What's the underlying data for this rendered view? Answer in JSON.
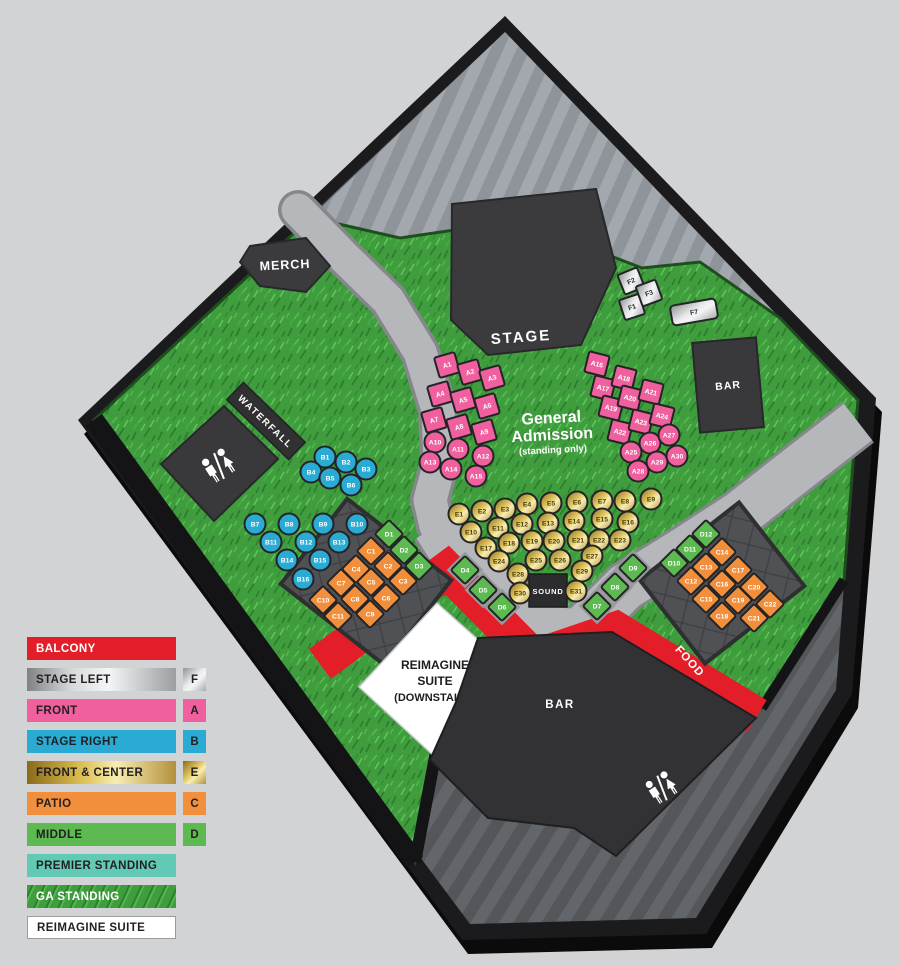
{
  "map": {
    "labels": {
      "stage": "STAGE",
      "merch": "MERCH",
      "waterfall": "WATERFALL",
      "bar_stage": "BAR",
      "bar_main": "BAR",
      "food": "FOOD",
      "balcony": "BALCONY",
      "sound": "SOUND",
      "ga_line1": "General",
      "ga_line2": "Admission",
      "ga_line3": "(standing only)",
      "suite_line1": "REIMAGINE",
      "suite_line2": "SUITE",
      "suite_line3": "(DOWNSTAIRS)"
    },
    "colors": {
      "balcony_red": "#e31e29",
      "front_pink": "#f0609e",
      "stage_right_cyan": "#29abd4",
      "patio_orange": "#f28f3d",
      "middle_green": "#5cba51",
      "premier_teal": "#62c9b5",
      "grass_green": "#3f9d3e",
      "gold_dark": "#8a6a1c",
      "gold_light": "#f8edb2",
      "silver_dark": "#8f9194",
      "silver_light": "#f4f5f6"
    },
    "seat_sections": [
      {
        "name": "front",
        "code": "A",
        "fill": "#f0609e",
        "text": "#ffffff",
        "seats": [
          [
            "A1",
            447,
            365,
            "sq",
            -16
          ],
          [
            "A2",
            470,
            372,
            "sq",
            -16
          ],
          [
            "A3",
            492,
            378,
            "sq",
            -16
          ],
          [
            "A4",
            440,
            394,
            "sq",
            -16
          ],
          [
            "A5",
            463,
            400,
            "sq",
            -16
          ],
          [
            "A6",
            487,
            406,
            "sq",
            -16
          ],
          [
            "A7",
            434,
            420,
            "sq",
            -16
          ],
          [
            "A8",
            459,
            427,
            "sq",
            -16
          ],
          [
            "A9",
            484,
            432,
            "sq",
            -16
          ],
          [
            "A10",
            435,
            442,
            "ci",
            0
          ],
          [
            "A11",
            458,
            449,
            "ci",
            0
          ],
          [
            "A12",
            483,
            456,
            "ci",
            0
          ],
          [
            "A13",
            430,
            462,
            "ci",
            0
          ],
          [
            "A14",
            451,
            469,
            "ci",
            0
          ],
          [
            "A15",
            476,
            476,
            "ci",
            0
          ],
          [
            "A16",
            597,
            364,
            "sq",
            14
          ],
          [
            "A17",
            603,
            388,
            "sq",
            14
          ],
          [
            "A18",
            624,
            378,
            "sq",
            14
          ],
          [
            "A19",
            611,
            408,
            "sq",
            14
          ],
          [
            "A20",
            630,
            398,
            "sq",
            14
          ],
          [
            "A21",
            651,
            392,
            "sq",
            14
          ],
          [
            "A22",
            620,
            432,
            "sq",
            14
          ],
          [
            "A23",
            641,
            422,
            "sq",
            14
          ],
          [
            "A24",
            662,
            416,
            "sq",
            14
          ],
          [
            "A25",
            631,
            452,
            "ci",
            0
          ],
          [
            "A26",
            650,
            443,
            "ci",
            0
          ],
          [
            "A27",
            669,
            435,
            "ci",
            0
          ],
          [
            "A28",
            638,
            471,
            "ci",
            0
          ],
          [
            "A29",
            657,
            462,
            "ci",
            0
          ],
          [
            "A30",
            677,
            456,
            "ci",
            0
          ]
        ]
      },
      {
        "name": "stage-right",
        "code": "B",
        "fill": "#29abd4",
        "text": "#ffffff",
        "seats": [
          [
            "B1",
            325,
            457,
            "ci",
            0
          ],
          [
            "B2",
            346,
            462,
            "ci",
            0
          ],
          [
            "B3",
            366,
            469,
            "ci",
            0
          ],
          [
            "B4",
            311,
            472,
            "ci",
            0
          ],
          [
            "B5",
            330,
            478,
            "ci",
            0
          ],
          [
            "B6",
            351,
            485,
            "ci",
            0
          ],
          [
            "B7",
            255,
            524,
            "ci",
            0
          ],
          [
            "B8",
            289,
            524,
            "ci",
            0
          ],
          [
            "B9",
            323,
            524,
            "ci",
            0
          ],
          [
            "B10",
            357,
            524,
            "ci",
            0
          ],
          [
            "B11",
            271,
            542,
            "ci",
            0
          ],
          [
            "B12",
            306,
            542,
            "ci",
            0
          ],
          [
            "B13",
            339,
            542,
            "ci",
            0
          ],
          [
            "B14",
            287,
            560,
            "ci",
            0
          ],
          [
            "B15",
            320,
            560,
            "ci",
            0
          ],
          [
            "B16",
            303,
            579,
            "ci",
            0
          ]
        ]
      },
      {
        "name": "patio",
        "code": "C",
        "fill": "#f28f3d",
        "text": "#ffffff",
        "seats": [
          [
            "C1",
            371,
            551,
            "di",
            45
          ],
          [
            "C2",
            388,
            566,
            "di",
            45
          ],
          [
            "C3",
            403,
            581,
            "di",
            45
          ],
          [
            "C4",
            356,
            569,
            "di",
            45
          ],
          [
            "C5",
            371,
            582,
            "di",
            45
          ],
          [
            "C6",
            386,
            598,
            "di",
            45
          ],
          [
            "C7",
            341,
            583,
            "di",
            45
          ],
          [
            "C8",
            355,
            599,
            "di",
            45
          ],
          [
            "C9",
            370,
            614,
            "di",
            45
          ],
          [
            "C10",
            323,
            600,
            "di",
            45
          ],
          [
            "C11",
            338,
            616,
            "di",
            45
          ],
          [
            "C12",
            691,
            581,
            "di",
            45
          ],
          [
            "C13",
            706,
            567,
            "di",
            45
          ],
          [
            "C14",
            722,
            552,
            "di",
            45
          ],
          [
            "C15",
            706,
            599,
            "di",
            45
          ],
          [
            "C16",
            722,
            584,
            "di",
            45
          ],
          [
            "C17",
            738,
            570,
            "di",
            45
          ],
          [
            "C18",
            722,
            616,
            "di",
            45
          ],
          [
            "C19",
            738,
            600,
            "di",
            45
          ],
          [
            "C20",
            754,
            587,
            "di",
            45
          ],
          [
            "C21",
            754,
            618,
            "di",
            45
          ],
          [
            "C22",
            770,
            604,
            "di",
            45
          ]
        ]
      },
      {
        "name": "middle",
        "code": "D",
        "fill": "#5cba51",
        "text": "#ffffff",
        "seats": [
          [
            "D1",
            389,
            534,
            "di",
            45
          ],
          [
            "D2",
            404,
            550,
            "di",
            45
          ],
          [
            "D3",
            419,
            566,
            "di",
            45
          ],
          [
            "D4",
            465,
            570,
            "di",
            45,
            1
          ],
          [
            "D5",
            483,
            590,
            "di",
            45,
            1
          ],
          [
            "D6",
            502,
            607,
            "di",
            45,
            1
          ],
          [
            "D7",
            597,
            606,
            "di",
            45,
            1
          ],
          [
            "D8",
            615,
            587,
            "di",
            45,
            1
          ],
          [
            "D9",
            633,
            568,
            "di",
            45,
            1
          ],
          [
            "D10",
            674,
            563,
            "di",
            45
          ],
          [
            "D11",
            690,
            549,
            "di",
            45
          ],
          [
            "D12",
            706,
            534,
            "di",
            45
          ]
        ]
      },
      {
        "name": "front-center",
        "code": "E",
        "fill": "gold",
        "text": "#4a3a08",
        "seats": [
          [
            "E1",
            459,
            514,
            "ci",
            0
          ],
          [
            "E2",
            482,
            511,
            "ci",
            0
          ],
          [
            "E3",
            505,
            509,
            "ci",
            0
          ],
          [
            "E4",
            527,
            504,
            "ci",
            0
          ],
          [
            "E5",
            551,
            503,
            "ci",
            0
          ],
          [
            "E6",
            577,
            502,
            "ci",
            0
          ],
          [
            "E7",
            602,
            501,
            "ci",
            0
          ],
          [
            "E8",
            625,
            501,
            "ci",
            0
          ],
          [
            "E9",
            651,
            499,
            "ci",
            0
          ],
          [
            "E10",
            471,
            532,
            "ci",
            0
          ],
          [
            "E11",
            498,
            528,
            "ci",
            0
          ],
          [
            "E12",
            522,
            524,
            "ci",
            0
          ],
          [
            "E13",
            548,
            523,
            "ci",
            0
          ],
          [
            "E14",
            574,
            521,
            "ci",
            0
          ],
          [
            "E15",
            602,
            519,
            "ci",
            0
          ],
          [
            "E16",
            628,
            522,
            "ci",
            0
          ],
          [
            "E17",
            486,
            548,
            "ci",
            0
          ],
          [
            "E18",
            509,
            543,
            "ci",
            0
          ],
          [
            "E19",
            532,
            541,
            "ci",
            0
          ],
          [
            "E20",
            554,
            541,
            "ci",
            0
          ],
          [
            "E21",
            578,
            540,
            "ci",
            0
          ],
          [
            "E22",
            599,
            540,
            "ci",
            0
          ],
          [
            "E23",
            620,
            540,
            "ci",
            0
          ],
          [
            "E24",
            499,
            561,
            "ci",
            0
          ],
          [
            "E25",
            536,
            560,
            "ci",
            0
          ],
          [
            "E26",
            560,
            560,
            "ci",
            0
          ],
          [
            "E27",
            592,
            556,
            "ci",
            0
          ],
          [
            "E28",
            518,
            574,
            "ci",
            0
          ],
          [
            "E29",
            582,
            571,
            "ci",
            0
          ],
          [
            "E30",
            520,
            593,
            "ci",
            0
          ],
          [
            "E31",
            576,
            591,
            "ci",
            0
          ]
        ]
      },
      {
        "name": "stage-left",
        "code": "F",
        "fill": "silver",
        "text": "#2b2b2b",
        "seats": [
          [
            "F1",
            632,
            307,
            "sq",
            -18
          ],
          [
            "F2",
            631,
            281,
            "sq",
            -22
          ],
          [
            "F3",
            649,
            293,
            "sq",
            -20
          ],
          [
            "F7",
            694,
            312,
            "pill",
            -10
          ]
        ]
      }
    ]
  },
  "legend": {
    "items": [
      {
        "label": "BALCONY",
        "swatch": "solid",
        "color": "#e31e29",
        "label_color": "#ffffff",
        "chip": null
      },
      {
        "label": "STAGE LEFT",
        "swatch": "silver",
        "color": null,
        "label_color": "#231f20",
        "chip": "F"
      },
      {
        "label": "FRONT",
        "swatch": "solid",
        "color": "#f0609e",
        "label_color": "#231f20",
        "chip": "A"
      },
      {
        "label": "STAGE RIGHT",
        "swatch": "solid",
        "color": "#29abd4",
        "label_color": "#231f20",
        "chip": "B"
      },
      {
        "label": "FRONT & CENTER",
        "swatch": "gold",
        "color": null,
        "label_color": "#231f20",
        "chip": "E"
      },
      {
        "label": "PATIO",
        "swatch": "solid",
        "color": "#f28f3d",
        "label_color": "#231f20",
        "chip": "C"
      },
      {
        "label": "MIDDLE",
        "swatch": "solid",
        "color": "#5cba51",
        "label_color": "#231f20",
        "chip": "D"
      },
      {
        "label": "PREMIER STANDING",
        "swatch": "solid",
        "color": "#62c9b5",
        "label_color": "#231f20",
        "chip": null
      },
      {
        "label": "GA STANDING",
        "swatch": "grass",
        "color": null,
        "label_color": "#ffffff",
        "chip": null
      },
      {
        "label": "REIMAGINE SUITE",
        "swatch": "white",
        "color": null,
        "label_color": "#231f20",
        "chip": null
      }
    ]
  }
}
